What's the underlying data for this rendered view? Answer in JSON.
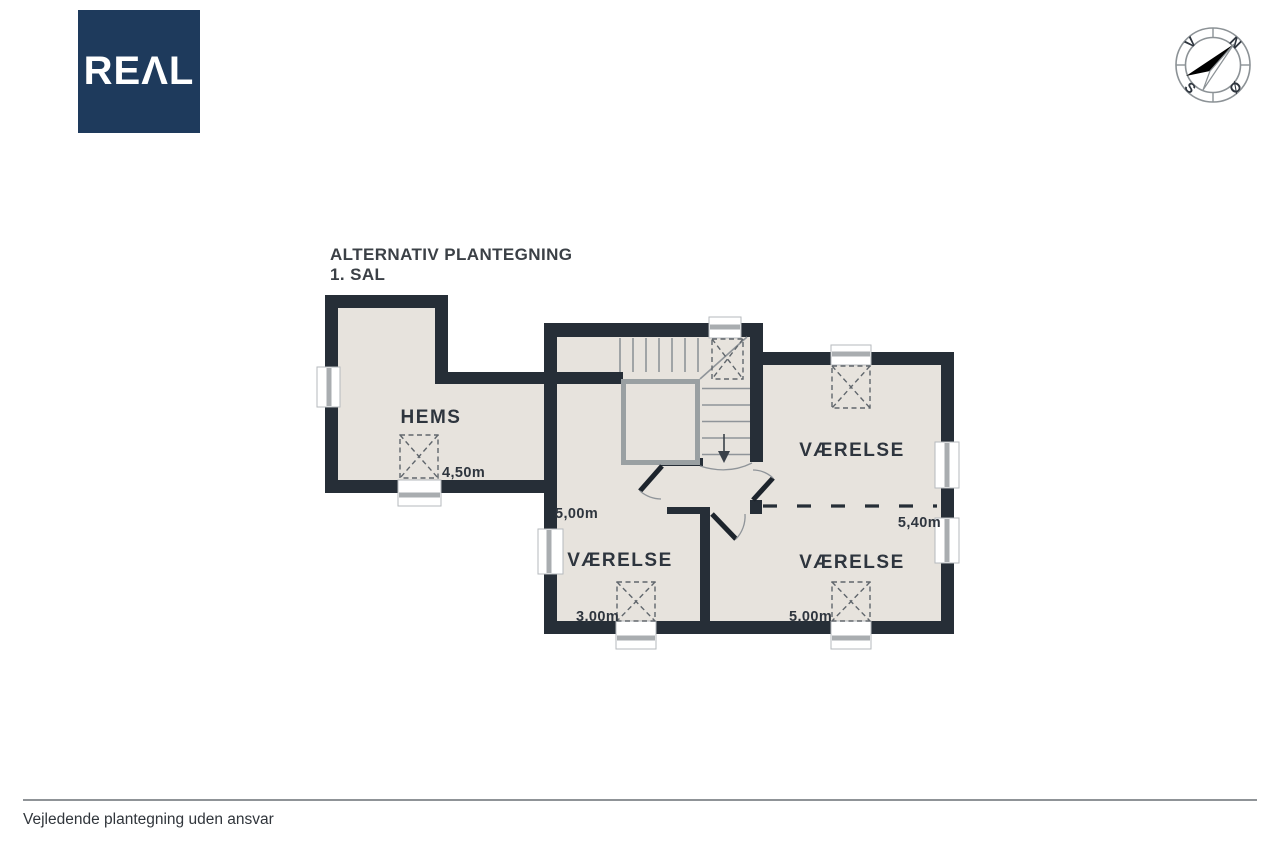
{
  "logo": {
    "text": "REΛL"
  },
  "title": {
    "line1": "ALTERNATIV PLANTEGNING",
    "line2": "1. SAL"
  },
  "compass": {
    "n": "N",
    "e": "Ø",
    "s": "S",
    "w": "V"
  },
  "rooms": {
    "hems": {
      "label": "HEMS",
      "width": "4,50m"
    },
    "left": {
      "label": "VÆRELSE",
      "width": "3,00m",
      "depth": "5,00m"
    },
    "top_right": {
      "label": "VÆRELSE",
      "width": "5,40m"
    },
    "bottom_right": {
      "label": "VÆRELSE",
      "width": "5,00m"
    }
  },
  "footer": {
    "disclaimer": "Vejledende plantegning uden ansvar"
  },
  "colors": {
    "wall": "#262e37",
    "floor": "#e7e3dd",
    "logo_bg": "#1e3a5c",
    "window_stripe": "#a9adb0",
    "window_edge": "#b6babd",
    "void_line": "#9aa0a2",
    "stair_line": "#8f9499",
    "sky_line": "#60666c",
    "door_ink": "#1d242c",
    "label_ink": "#2e353e",
    "title_ink": "#3b4046",
    "rule_line": "#8f9397",
    "footer_ink": "#30353b",
    "compass_line": "#8c9296"
  }
}
